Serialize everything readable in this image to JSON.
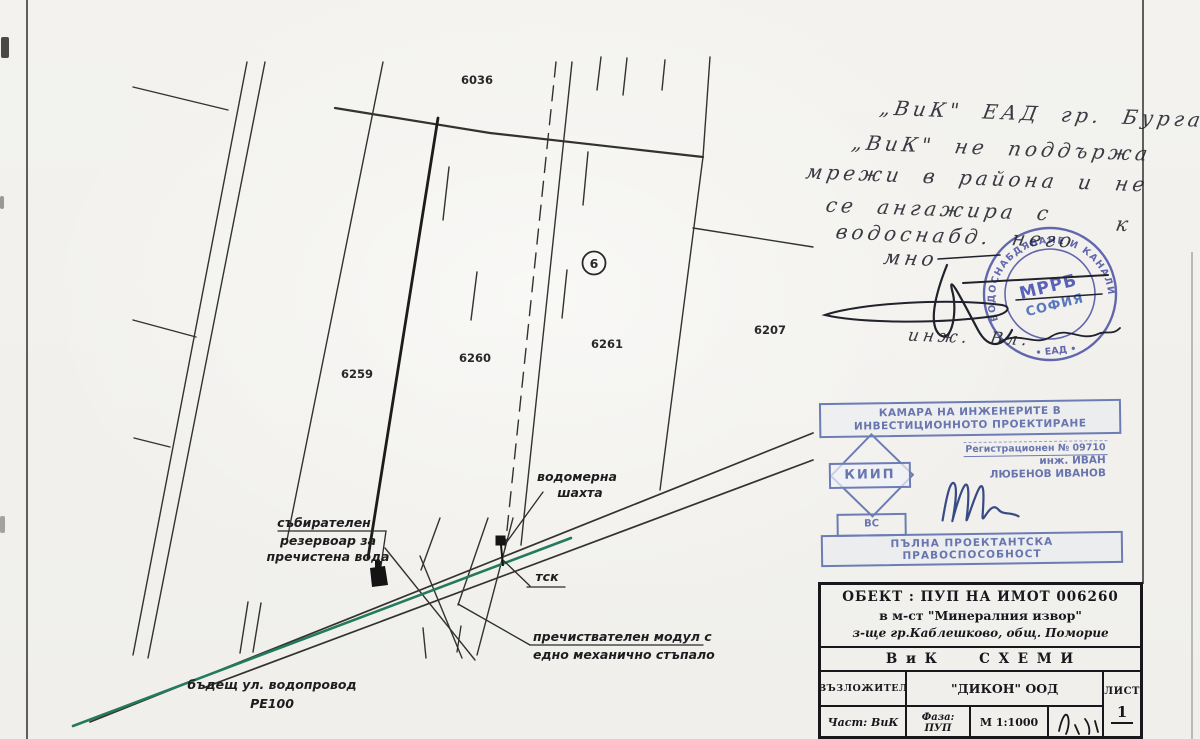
{
  "drawing": {
    "plot_numbers": {
      "p6036": "6036",
      "p6259": "6259",
      "p6260": "6260",
      "p6261": "6261",
      "p6207": "6207"
    },
    "circle_marker": "6",
    "labels": {
      "meter1": "водомерна",
      "meter2": "шахта",
      "res1": "събирателен",
      "res2": "резервоар за",
      "res3": "пречистена вода",
      "tsk": "тск",
      "mod1": "пречиствателен модул с",
      "mod2": "едно механично стъпало",
      "pipe1": "бъдещ ул. водопровод",
      "pipe2": "PE100"
    }
  },
  "handwriting": {
    "line1": "„ВиК\" ЕАД гр. Бургас",
    "line2": "„ВиК\" не поддържа",
    "line3": "мрежи в района и не",
    "line4": "се ангажира с",
    "line5": "водоснабд. него",
    "line5_k": "к",
    "line6": "мно",
    "signature_name": "инж. Вл."
  },
  "round_stamp": {
    "ring_top": "ВОДОСНАБДЯВАНЕ И КАНАЛИЗАЦИЯ",
    "ring_bottom": "• ЕАД •",
    "center1": "МРРБ",
    "center2": "СОФИЯ"
  },
  "kiip_stamp": {
    "header1": "КАМАРА НА ИНЖЕНЕРИТЕ В",
    "header2": "ИНВЕСТИЦИОННОТО ПРОЕКТИРАНЕ",
    "registration": "Регистрационен № 09710",
    "engineer1": "инж. ИВАН",
    "engineer2": "ЛЮБЕНОВ ИВАНОВ",
    "logo": "КИИП",
    "section": "ВС",
    "footer": "ПЪЛНА ПРОЕКТАНТСКА ПРАВОСПОСОБНОСТ"
  },
  "title_block": {
    "object_line1": "ОБЕКТ : ПУП НА ИМОТ 006260",
    "object_line2": "в м-ст \"Минералния извор\"",
    "object_line3": "з-ще гр.Каблешково, общ. Поморие",
    "sheet_title": "В и К      С Х Е М И",
    "client_label": "ВЪЗЛОЖИТЕЛ",
    "client_value": "\"ДИКОН\" ООД",
    "part": "Част: ВиК",
    "phase": "Фаза: ПУП",
    "scale": "М 1:1000",
    "sheet_label": "ЛИСТ",
    "sheet_number": "1"
  },
  "colors": {
    "paper": "#f2f1ed",
    "ink": "#20222c",
    "line_black": "#33322f",
    "pipe_green": "#237a5f",
    "stamp_blue": "#4950a3",
    "kiip_blue": "#5e6cab"
  }
}
